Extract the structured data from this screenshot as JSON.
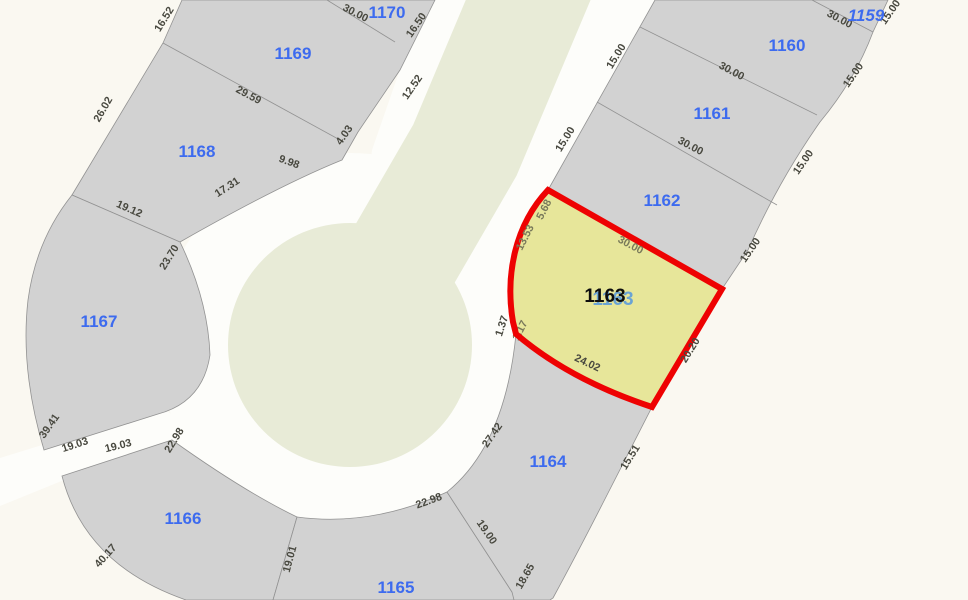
{
  "map": {
    "selected": {
      "id": "1163"
    },
    "parcels": [
      {
        "id": "1159"
      },
      {
        "id": "1160"
      },
      {
        "id": "1161"
      },
      {
        "id": "1162"
      },
      {
        "id": "1163"
      },
      {
        "id": "1164"
      },
      {
        "id": "1165"
      },
      {
        "id": "1166"
      },
      {
        "id": "1167"
      },
      {
        "id": "1168"
      },
      {
        "id": "1169"
      },
      {
        "id": "1170"
      }
    ],
    "dims": [
      {
        "v": "16.52"
      },
      {
        "v": "30.00"
      },
      {
        "v": "16.50"
      },
      {
        "v": "12.52"
      },
      {
        "v": "29.59"
      },
      {
        "v": "4.03"
      },
      {
        "v": "26.02"
      },
      {
        "v": "9.98"
      },
      {
        "v": "17.31"
      },
      {
        "v": "19.12"
      },
      {
        "v": "23.70"
      },
      {
        "v": "39.41"
      },
      {
        "v": "19.03"
      },
      {
        "v": "19.03"
      },
      {
        "v": "40.17"
      },
      {
        "v": "22.98"
      },
      {
        "v": "19.01"
      },
      {
        "v": "22.98"
      },
      {
        "v": "19.00"
      },
      {
        "v": "18.65"
      },
      {
        "v": "27.42"
      },
      {
        "v": "15.51"
      },
      {
        "v": "24.02"
      },
      {
        "v": "20.20"
      },
      {
        "v": "1.37"
      },
      {
        "v": "1.17"
      },
      {
        "v": "13.53"
      },
      {
        "v": "5.68"
      },
      {
        "v": "30.00"
      },
      {
        "v": "30.00"
      },
      {
        "v": "30.00"
      },
      {
        "v": "30.00"
      },
      {
        "v": "15.00"
      },
      {
        "v": "15.00"
      },
      {
        "v": "15.00"
      },
      {
        "v": "15.00"
      },
      {
        "v": "15.00"
      },
      {
        "v": "15.00"
      }
    ],
    "colors": {
      "background": "#faf8f1",
      "road": "#fdfdfa",
      "median": "#e8ebd7",
      "parcel_fill": "#d2d2d2",
      "parcel_stroke": "#929292",
      "selected_fill": "#e7e69a",
      "selected_stroke": "#ee0202",
      "parcel_label": "#3d6bef",
      "selected_label": "#0d0d0d",
      "ghost_label": "#64a0d8",
      "dim_label": "#48483f",
      "dim_olive": "#79795a"
    }
  }
}
